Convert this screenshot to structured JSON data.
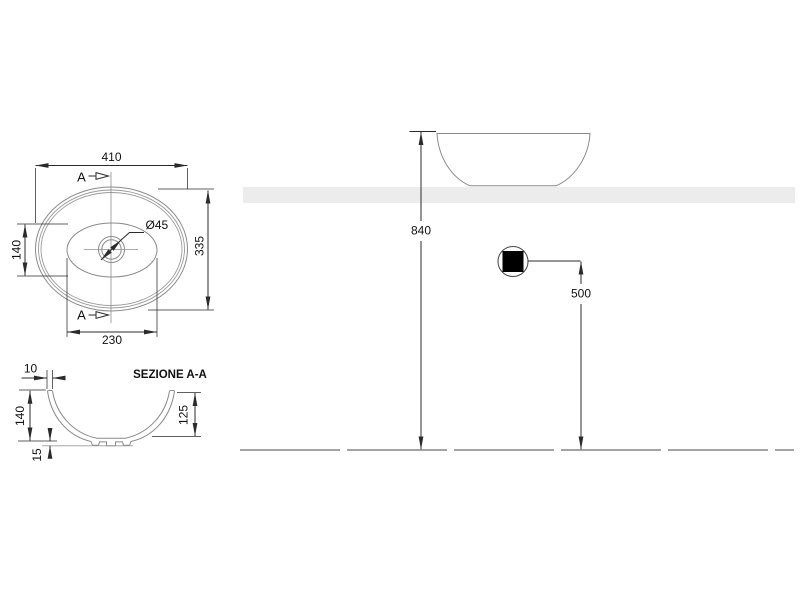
{
  "drawing": {
    "plan": {
      "dim_width": "410",
      "dim_depth": "335",
      "dim_inner_depth": "140",
      "dim_inner_width": "230",
      "dim_drain": "Ø45",
      "section_marker": "A"
    },
    "section": {
      "title": "SEZIONE A-A",
      "dim_wall_thickness": "10",
      "dim_height": "140",
      "dim_inner_depth": "125",
      "dim_base_clearance": "15"
    },
    "elevation": {
      "dim_rim_height": "840",
      "dim_drain_height": "500"
    },
    "colors": {
      "object_line": "#8a8a8a",
      "dimension_line": "#2b2b2b",
      "countertop_fill": "#ececec",
      "drain_fill": "#000000",
      "background": "#ffffff"
    }
  }
}
